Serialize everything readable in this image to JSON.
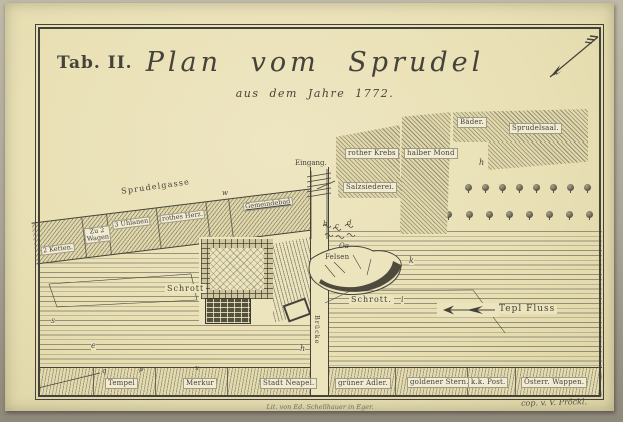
{
  "page": {
    "tab_label": "Tab. II.",
    "title": "Plan vom Sprudel",
    "subtitle": "aus dem Jahre 1772.",
    "credits": {
      "lithographer": "Lit. von Ed. Schellhauer in Eger.",
      "copyist": "cop. v. V. Pröckl."
    }
  },
  "map": {
    "street": {
      "label": "Sprudelgasse"
    },
    "river": {
      "label": "Tepl Fluss",
      "flow_direction": "west"
    },
    "bridge": {
      "label": "Brücke"
    },
    "entrance": {
      "label": "Eingang."
    },
    "rock": {
      "label": "Felsen"
    },
    "debris_left": {
      "label": "Schrott"
    },
    "debris_right": {
      "label": "Schrott."
    },
    "spring": {
      "label": "Oa"
    },
    "upper_buildings": [
      {
        "label": "rother Krebs"
      },
      {
        "label": "halber Mond"
      },
      {
        "label": "Bäder."
      },
      {
        "label": "Sprudelsaal."
      },
      {
        "label": "Salzsiederei."
      }
    ],
    "street_buildings": [
      {
        "label": "2 Ketten."
      },
      {
        "label": "Zu 2 Wagen"
      },
      {
        "label": "3 Uhlanen"
      },
      {
        "label": "rothes Herz."
      },
      {
        "label": "Gemeindebad"
      }
    ],
    "bottom_buildings": [
      {
        "label": "Tempel"
      },
      {
        "label": "Merkur"
      },
      {
        "label": "Stadt Neapel."
      },
      {
        "label": "grüner Adler."
      },
      {
        "label": "goldener Stern."
      },
      {
        "label": "k.k. Post."
      },
      {
        "label": "Österr. Wappen."
      }
    ],
    "markers": [
      "h",
      "h",
      "k",
      "i",
      "s",
      "e",
      "q",
      "p",
      "x",
      "b",
      "c",
      "d",
      "w"
    ]
  },
  "colors": {
    "paper": "#e9e0b5",
    "paper2": "#ece4bd",
    "ink": "#45423a",
    "labelbg": "#f1ebd2"
  }
}
